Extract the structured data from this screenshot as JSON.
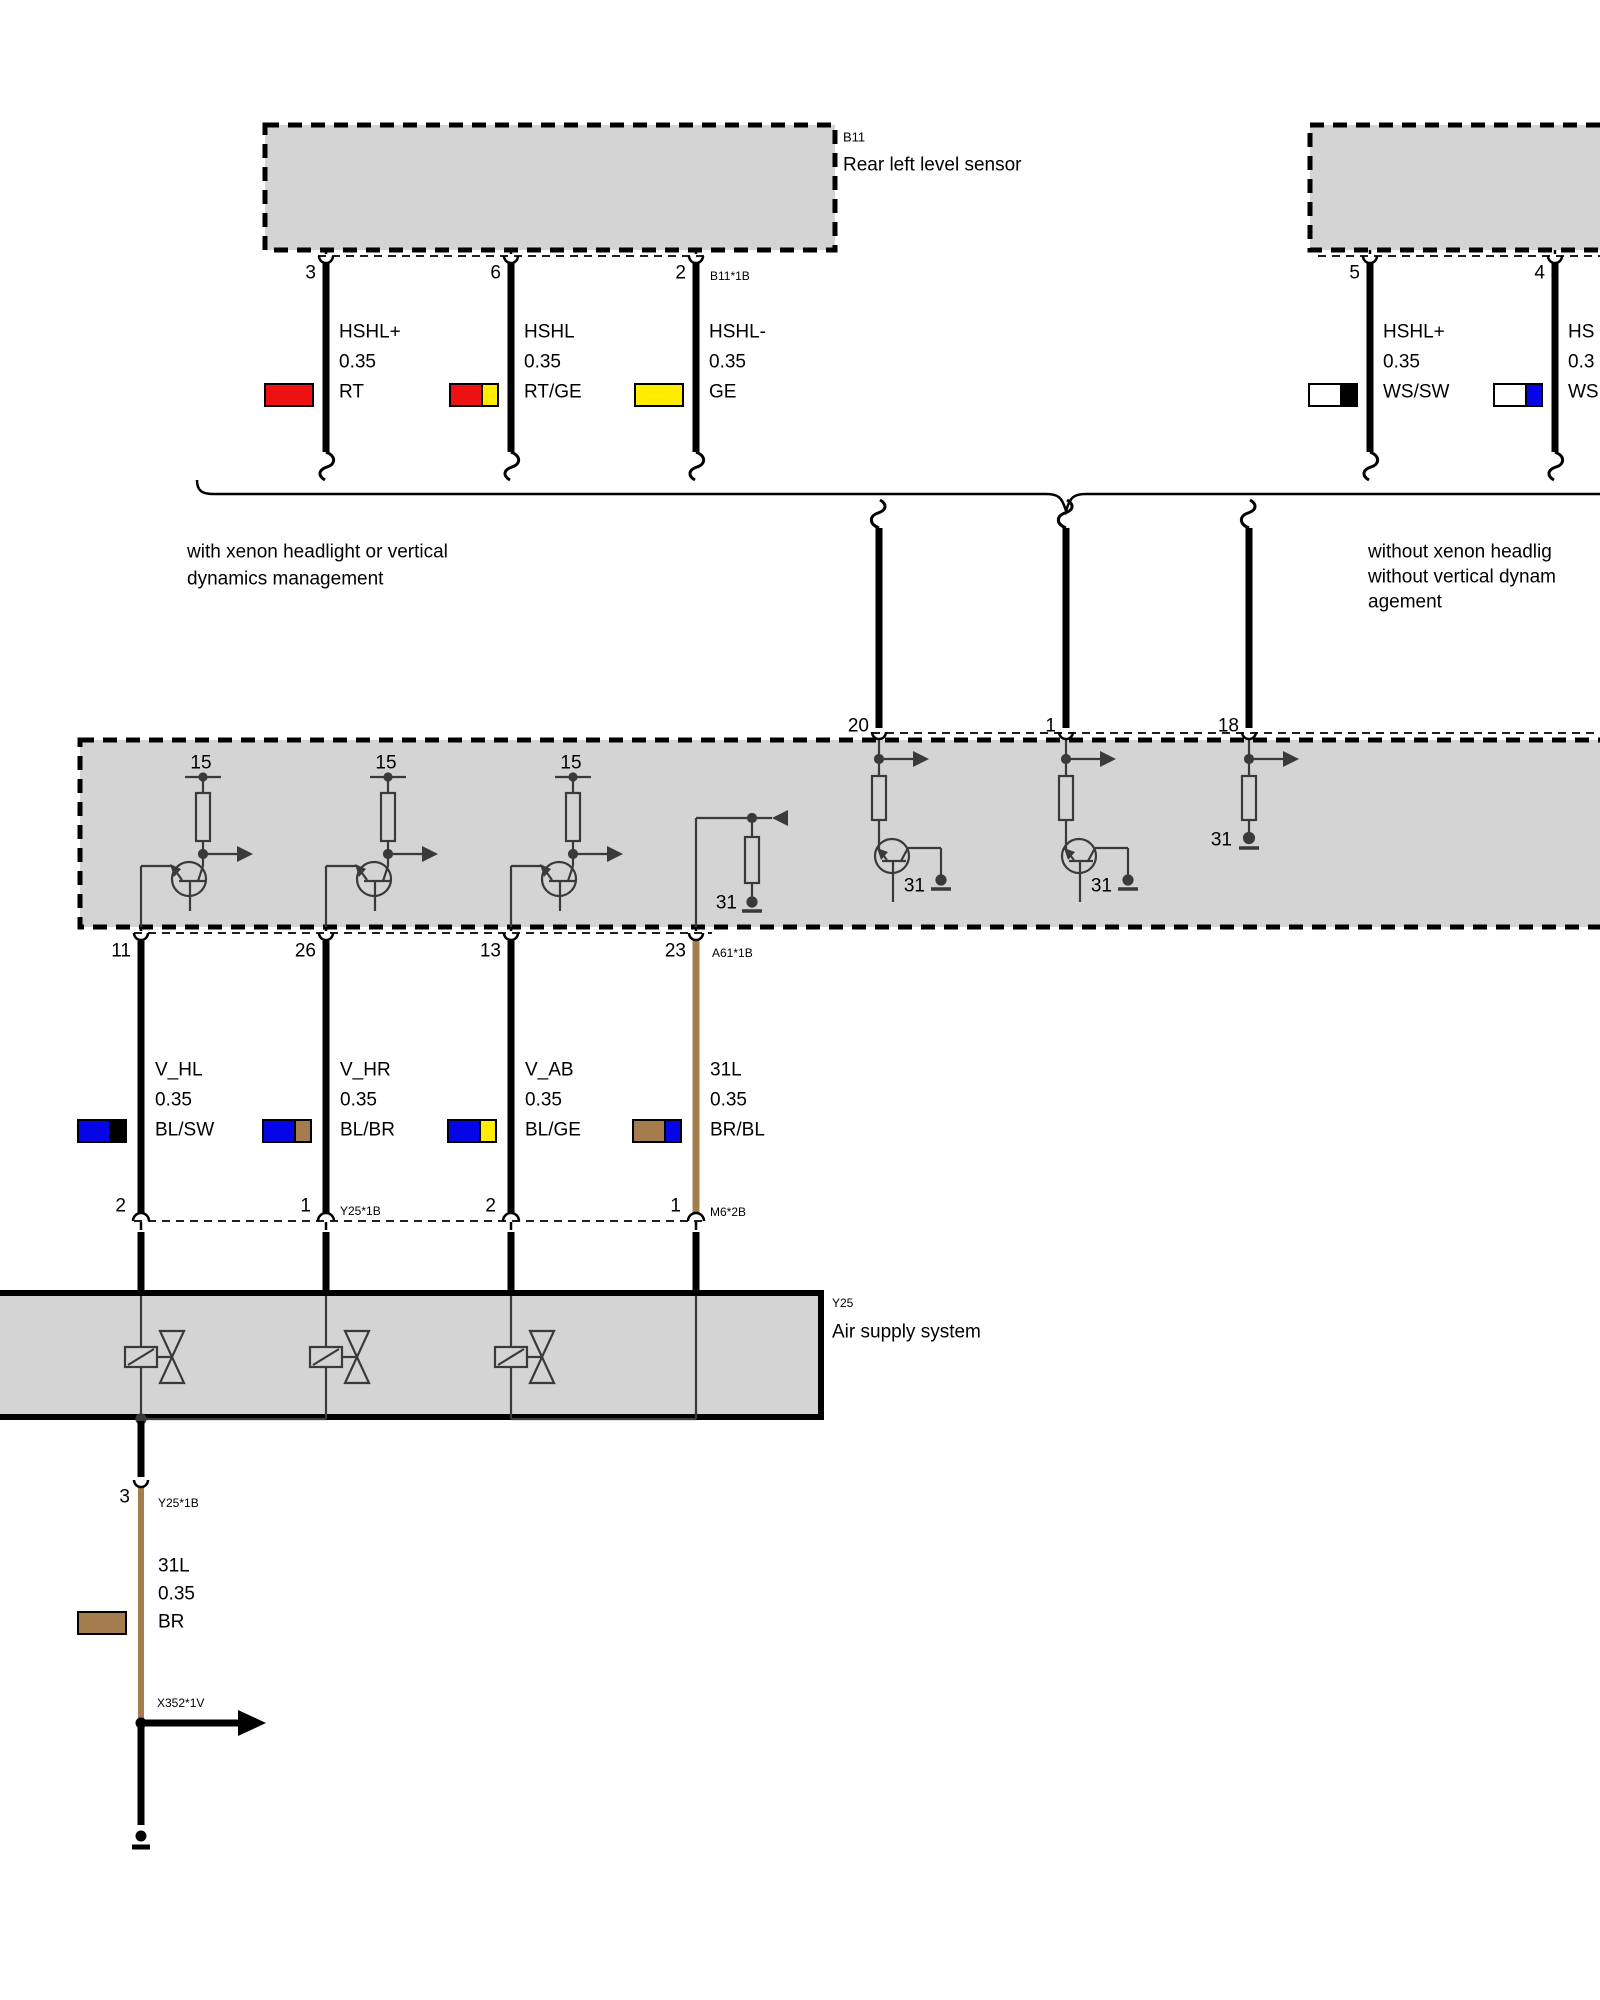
{
  "colors": {
    "red": "#ee1111",
    "yellow": "#ffec00",
    "blue": "#0505e8",
    "brown": "#a57c4d",
    "white": "#ffffff",
    "black": "#000000",
    "boxfill": "#d4d4d4",
    "line": "#3a3a3a"
  },
  "sensor_left": {
    "id": "B11",
    "name": "Rear left level sensor",
    "connector": "B11*1B",
    "pins": [
      {
        "number": "3",
        "signal": "HSHL+",
        "gauge": "0.35",
        "color_code": "RT"
      },
      {
        "number": "6",
        "signal": "HSHL",
        "gauge": "0.35",
        "color_code": "RT/GE"
      },
      {
        "number": "2",
        "signal": "HSHL-",
        "gauge": "0.35",
        "color_code": "GE"
      }
    ]
  },
  "sensor_right": {
    "pins": [
      {
        "number": "5",
        "signal": "HSHL+",
        "gauge": "0.35",
        "color_code": "WS/SW"
      },
      {
        "number": "4",
        "signal": "HS",
        "gauge": "0.3",
        "color_code": "WS"
      }
    ]
  },
  "variant_notes": {
    "left": [
      "with xenon headlight or vertical",
      "dynamics management"
    ],
    "right": [
      "without xenon headlig",
      "without vertical dynam",
      "agement"
    ]
  },
  "control_unit": {
    "top_pins": [
      "20",
      "1",
      "18"
    ],
    "bottom_connector": "A61*1B",
    "terminal_15": "15",
    "terminal_31": "31",
    "bottom_pins": [
      {
        "number": "11",
        "signal": "V_HL",
        "gauge": "0.35",
        "color_code": "BL/SW",
        "lower_pin": "2"
      },
      {
        "number": "26",
        "signal": "V_HR",
        "gauge": "0.35",
        "color_code": "BL/BR",
        "lower_pin": "1",
        "lower_connector": "Y25*1B"
      },
      {
        "number": "13",
        "signal": "V_AB",
        "gauge": "0.35",
        "color_code": "BL/GE",
        "lower_pin": "2"
      },
      {
        "number": "23",
        "signal": "31L",
        "gauge": "0.35",
        "color_code": "BR/BL",
        "lower_pin": "1",
        "lower_connector": "M6*2B"
      }
    ]
  },
  "air_supply": {
    "id": "Y25",
    "name": "Air supply system"
  },
  "ground_branch": {
    "pin": "3",
    "connector": "Y25*1B",
    "signal": "31L",
    "gauge": "0.35",
    "color_code": "BR",
    "splice": "X352*1V"
  }
}
